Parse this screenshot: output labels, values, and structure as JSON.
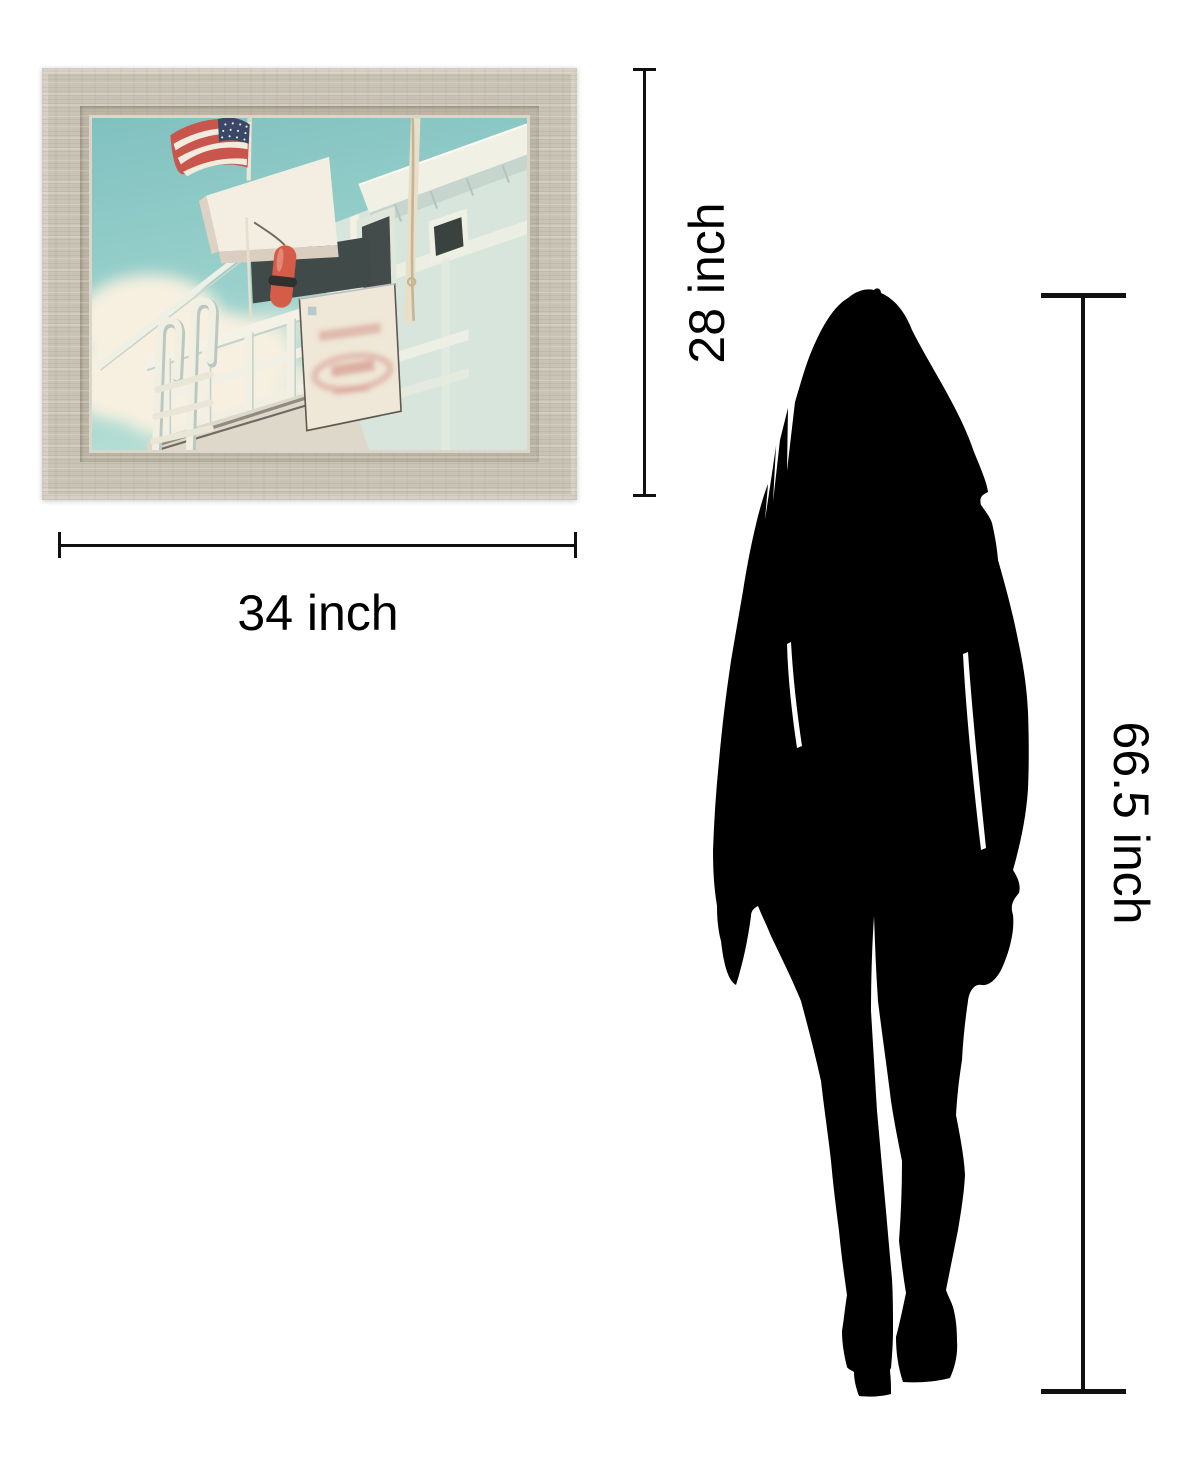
{
  "size_guide": {
    "artwork_frame": {
      "width_label": "34 inch",
      "height_label": "28 inch",
      "frame_color": "#c9c3b5",
      "art": {
        "sky_color": "#8ac6c3",
        "cloud_color": "#f7f0e0",
        "tower_wall_color": "#d7e5dd",
        "trim_color": "#f3f0e4",
        "flag_red": "#c8564c",
        "flag_white": "#f2ecdf",
        "flag_blue": "#3a4766",
        "buoy_red": "#d45c48",
        "sign_color": "#efe7d7",
        "sign_text_color": "#d4938a",
        "window_color": "#39423f"
      }
    },
    "person": {
      "height_label": "66.5 inch",
      "silhouette_color": "#000000"
    },
    "line_color": "#101010",
    "background_color": "#ffffff"
  }
}
